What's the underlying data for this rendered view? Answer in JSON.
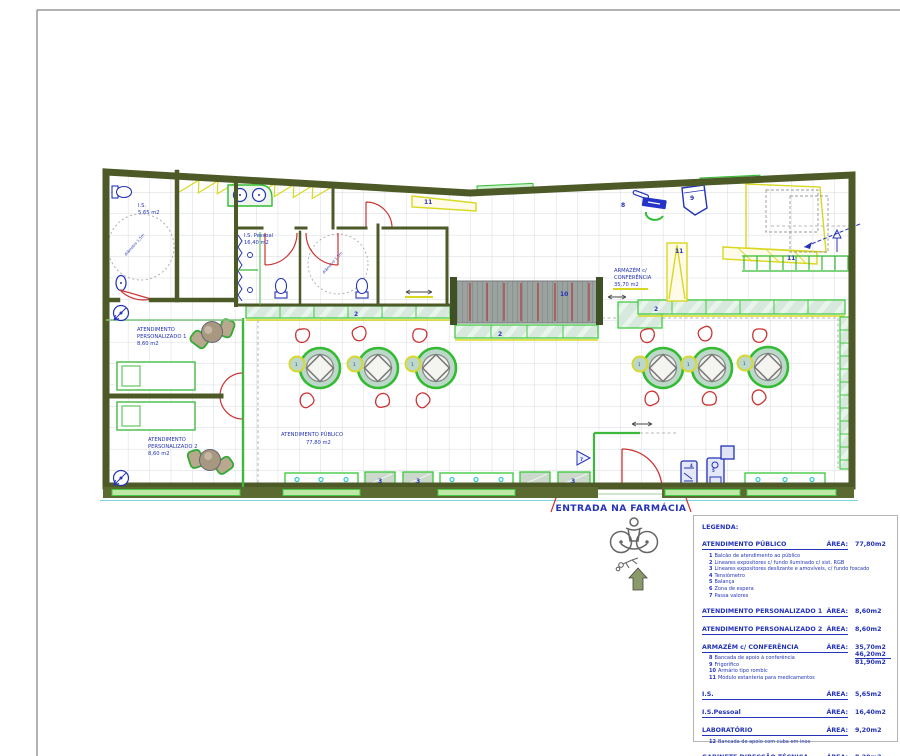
{
  "plan": {
    "entrance_label": "ENTRADA NA FARMÁCIA",
    "accessibility_circle": "diâmetro 1,5m",
    "rooms": {
      "is": {
        "name": "I.S.",
        "area": "5,65 m2"
      },
      "is_pessoal": {
        "name": "I.S. Pessoal",
        "area": "16,40 m2"
      },
      "ap1": {
        "line1": "ATENDIMENTO",
        "line2": "PERSONALIZADO 1",
        "area": "8,60 m2"
      },
      "ap2": {
        "line1": "ATENDIMENTO",
        "line2": "PERSONALIZADO 2",
        "area": "8,60 m2"
      },
      "apublico": {
        "name": "ATENDIMENTO  PÚBLICO",
        "area": "77,80 m2"
      },
      "armazem": {
        "line1": "ARMAZÉM c/",
        "line2": "CONFERÊNCIA",
        "area": "35,70 m2"
      }
    },
    "markers": {
      "m1": "1",
      "m2": "2",
      "m3": "3",
      "m4": "4",
      "m5": "5",
      "m7": "7",
      "m8": "8",
      "m9": "9",
      "m10": "10",
      "m11": "11"
    }
  },
  "legend": {
    "title": "LEGENDA:",
    "area_word": "ÁREA:",
    "sections": [
      {
        "name": "ATENDIMENTO PÚBLICO",
        "area": "77,80m2",
        "items": [
          {
            "n": "1",
            "t": "Balcão de atendimento ao público"
          },
          {
            "n": "2",
            "t": "Lineares expositores c/ fundo iluminado c/ sist. RGB"
          },
          {
            "n": "3",
            "t": "Lineares expositores deslizante e amovíveis, c/ fundo foscado"
          },
          {
            "n": "4",
            "t": "Tensiómetro"
          },
          {
            "n": "5",
            "t": "Balança"
          },
          {
            "n": "6",
            "t": "Zona de espera"
          },
          {
            "n": "7",
            "t": "Passa valores"
          }
        ]
      },
      {
        "name": "ATENDIMENTO PERSONALIZADO 1",
        "area": "8,60m2"
      },
      {
        "name": "ATENDIMENTO PERSONALIZADO 2",
        "area": "8,60m2"
      },
      {
        "name": "ARMAZÉM c/ CONFERÊNCIA",
        "area": "35,70m2",
        "extra": {
          "v1": "46,20m2",
          "v2": "81,90m2"
        },
        "items": [
          {
            "n": "8",
            "t": "Bancada de apoio à conferência"
          },
          {
            "n": "9",
            "t": "Frigorífico"
          },
          {
            "n": "10",
            "t": "Armário tipo rombic"
          },
          {
            "n": "11",
            "t": "Módulo estanteria para medicamentos"
          }
        ]
      },
      {
        "name": "I.S.",
        "area": "5,65m2"
      },
      {
        "name": "I.S.Pessoal",
        "area": "16,40m2"
      },
      {
        "name": "LABORATÓRIO",
        "area": "9,20m2",
        "items": [
          {
            "n": "12",
            "t": "Bancada de apoio com cuba em inox"
          }
        ]
      },
      {
        "name": "GABINETE DIRECÇÃO TÉCNICA",
        "area": "8,20m2"
      }
    ]
  },
  "colors": {
    "wall": "#4d5a28",
    "green": "#3cb93c",
    "light_green": "#d4e8da",
    "yellow": "#d8d820",
    "red": "#cc3333",
    "blue": "#2433b8",
    "cyan": "#30c8c8"
  }
}
